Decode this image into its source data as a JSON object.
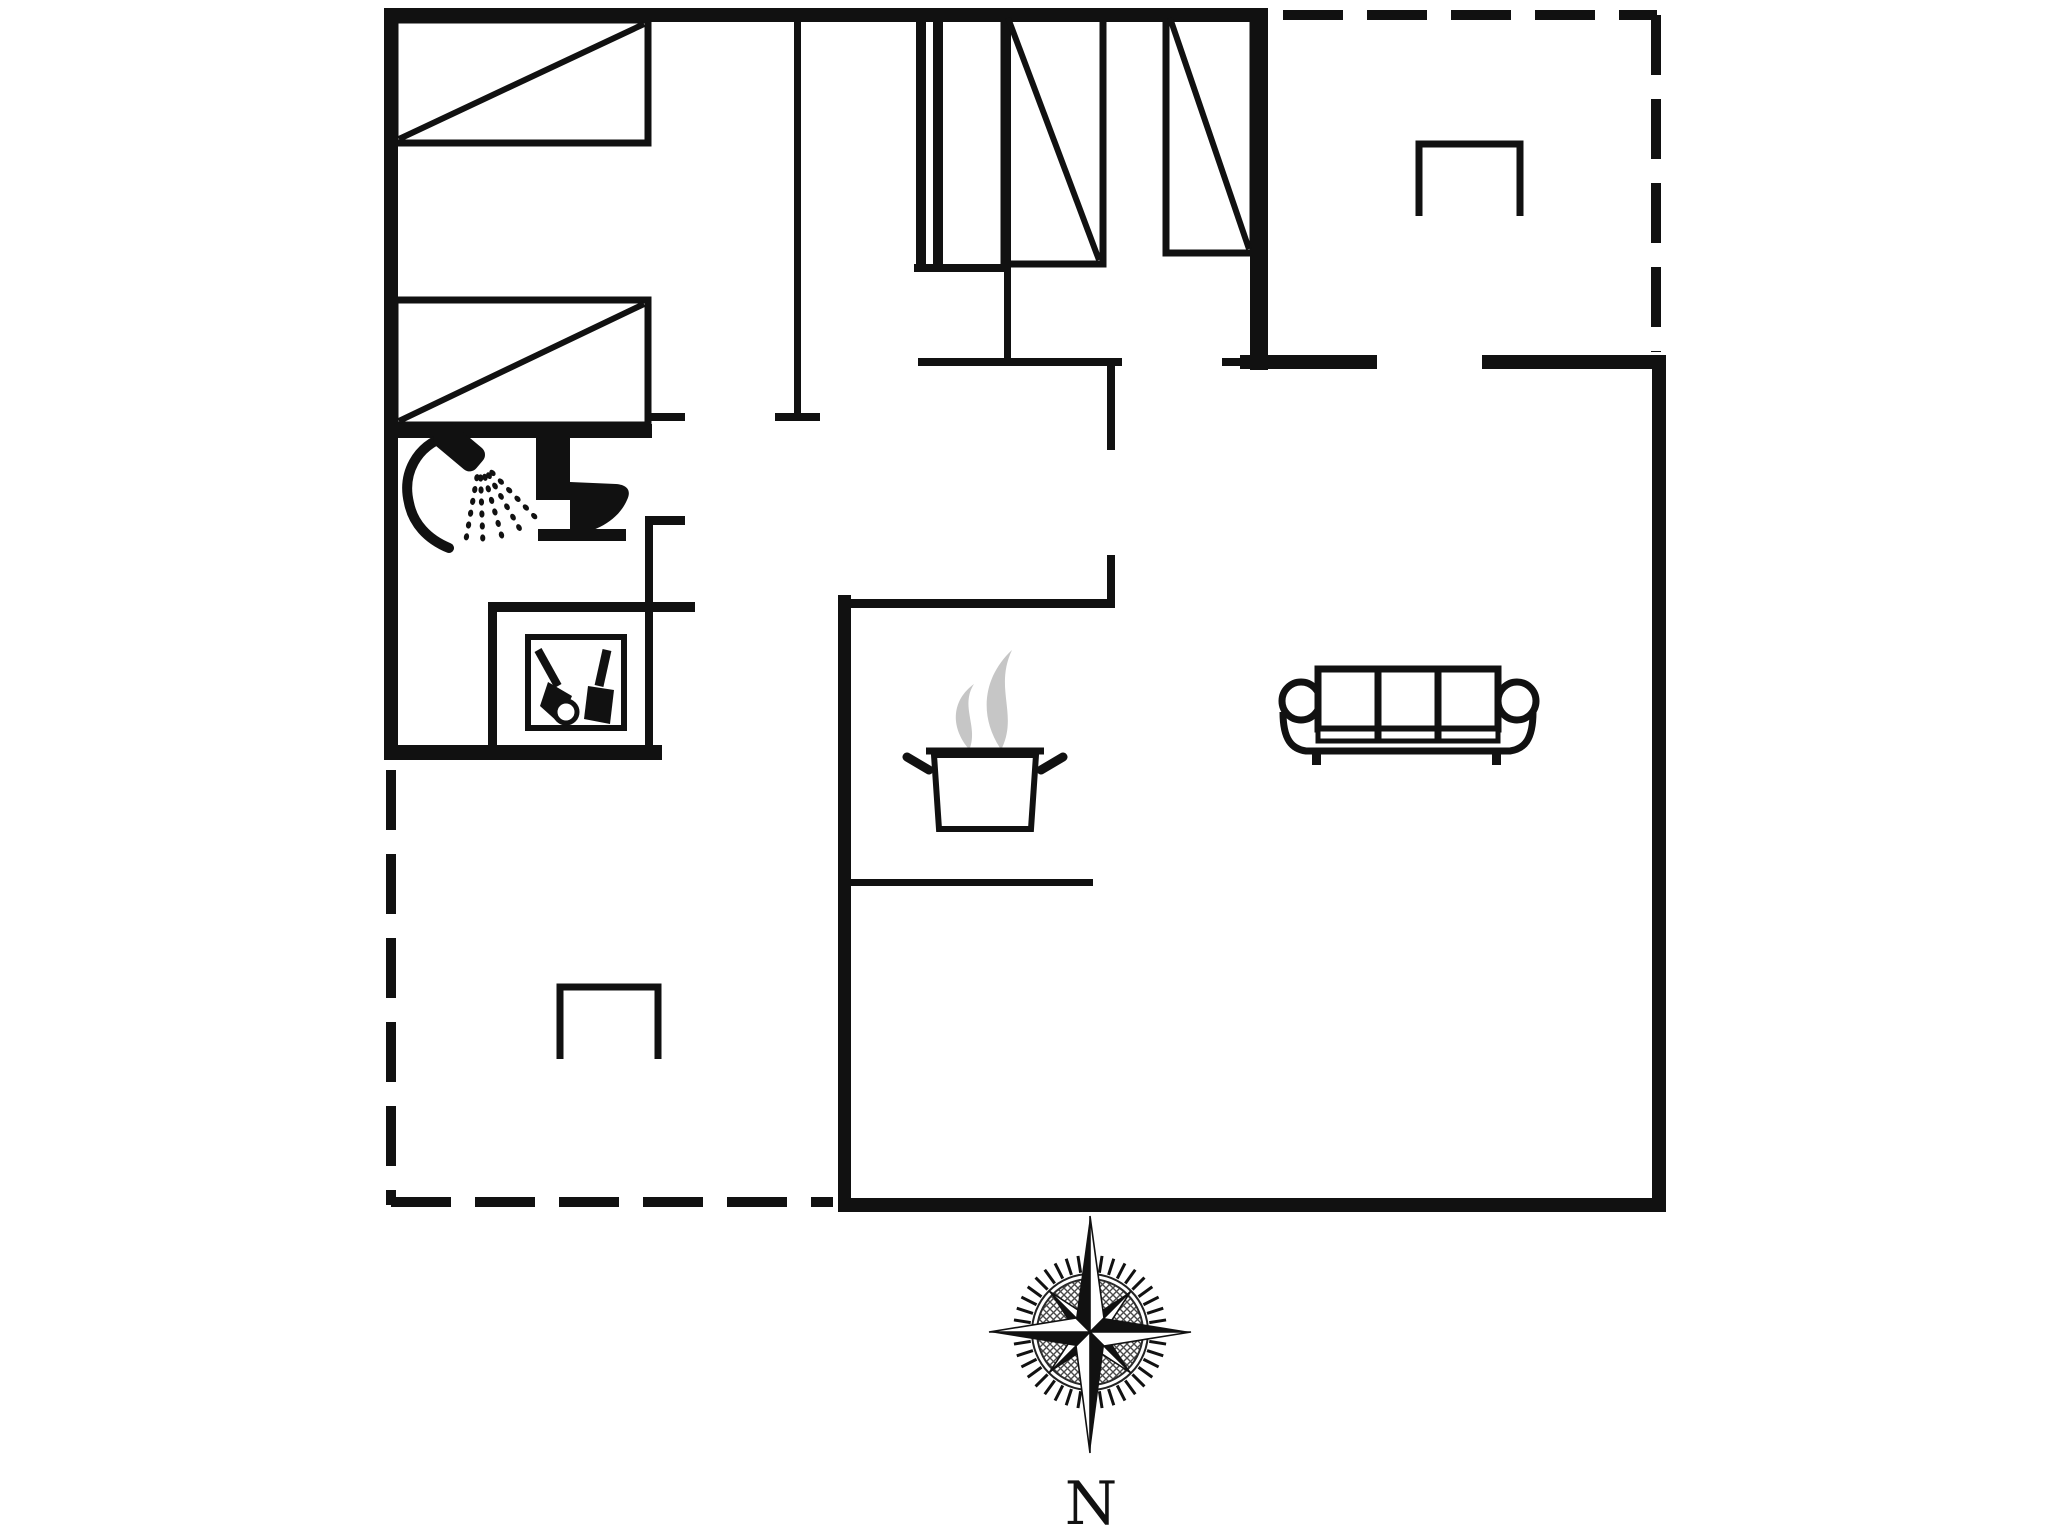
{
  "document": {
    "background": "#ffffff",
    "ink": "#111111",
    "steam_gray": "#c6c6c6"
  },
  "compass": {
    "north_label": "N",
    "cx": 1090,
    "cy": 1332,
    "tick_r1": 60,
    "tick_r2": 77,
    "tick_count": 40,
    "tick_sw": 3,
    "ring_r": 58,
    "disc_r": 53,
    "cardinal_len": [
      116,
      101,
      121,
      101
    ],
    "cardinal_hw": 14,
    "diag_len": 58,
    "diag_hw": 10,
    "outline_sw": 1.6
  },
  "plan": {
    "walls": [
      {
        "name": "outer-wall-top",
        "x": 384,
        "y": 8,
        "w": 884,
        "h": 14
      },
      {
        "name": "outer-wall-left",
        "x": 384,
        "y": 8,
        "w": 14,
        "h": 749
      },
      {
        "name": "bedroom1-south-wall",
        "x": 384,
        "y": 424,
        "w": 268,
        "h": 14
      },
      {
        "name": "bathroom-south-wall",
        "x": 384,
        "y": 745,
        "w": 278,
        "h": 15
      },
      {
        "name": "bedroom3-east-wall",
        "x": 1250,
        "y": 8,
        "w": 18,
        "h": 362
      },
      {
        "name": "living-north-wall-west",
        "x": 1240,
        "y": 355,
        "w": 137,
        "h": 14
      },
      {
        "name": "living-north-wall-east",
        "x": 1482,
        "y": 355,
        "w": 184,
        "h": 14
      },
      {
        "name": "living-east-wall",
        "x": 1652,
        "y": 355,
        "w": 14,
        "h": 857
      },
      {
        "name": "south-wall",
        "x": 838,
        "y": 1198,
        "w": 828,
        "h": 14
      },
      {
        "name": "kitchen-west-wall",
        "x": 838,
        "y": 595,
        "w": 13,
        "h": 615
      },
      {
        "name": "bedroom-partition-wall",
        "x": 794,
        "y": 14,
        "w": 7,
        "h": 402
      },
      {
        "name": "bedroom-partition-cap",
        "x": 775,
        "y": 413,
        "w": 45,
        "h": 8
      },
      {
        "name": "bedroom1-door-jamb",
        "x": 645,
        "y": 413,
        "w": 40,
        "h": 8
      },
      {
        "name": "bathroom-east-wall",
        "x": 645,
        "y": 518,
        "w": 8,
        "h": 232
      },
      {
        "name": "bathroom-door-jamb",
        "x": 645,
        "y": 516,
        "w": 40,
        "h": 9
      },
      {
        "name": "utility-niche-north-wall",
        "x": 488,
        "y": 602,
        "w": 207,
        "h": 10
      },
      {
        "name": "utility-niche-west-wall",
        "x": 488,
        "y": 602,
        "w": 9,
        "h": 150
      },
      {
        "name": "hall-north-wall",
        "x": 918,
        "y": 358,
        "w": 204,
        "h": 8
      },
      {
        "name": "hall-west-wall-upper",
        "x": 1107,
        "y": 358,
        "w": 8,
        "h": 92
      },
      {
        "name": "hall-door-jamb",
        "x": 1222,
        "y": 358,
        "w": 18,
        "h": 8
      },
      {
        "name": "hall-west-wall-lower",
        "x": 1107,
        "y": 555,
        "w": 8,
        "h": 51
      },
      {
        "name": "kitchen-north-wall",
        "x": 845,
        "y": 599,
        "w": 270,
        "h": 9
      },
      {
        "name": "kitchen-counter-edge",
        "x": 845,
        "y": 879,
        "w": 248,
        "h": 7
      },
      {
        "name": "bedroom2-east-wall",
        "x": 1004,
        "y": 12,
        "w": 7,
        "h": 350
      },
      {
        "name": "closet-line-a",
        "x": 916,
        "y": 12,
        "w": 10,
        "h": 260
      },
      {
        "name": "closet-line-b",
        "x": 933,
        "y": 12,
        "w": 10,
        "h": 260
      },
      {
        "name": "closet-bottom",
        "x": 914,
        "y": 264,
        "w": 94,
        "h": 8
      }
    ],
    "outlines": [
      {
        "name": "bed-1",
        "x": 395,
        "y": 20,
        "w": 253,
        "h": 123,
        "sw": 7
      },
      {
        "name": "bed-2",
        "x": 395,
        "y": 300,
        "w": 253,
        "h": 125,
        "sw": 7
      },
      {
        "name": "wardrobe-1",
        "x": 1004,
        "y": 14,
        "w": 99,
        "h": 250,
        "sw": 7
      },
      {
        "name": "wardrobe-2",
        "x": 1166,
        "y": 14,
        "w": 87,
        "h": 239,
        "sw": 7
      },
      {
        "name": "utility-appliance",
        "x": 528,
        "y": 637,
        "w": 96,
        "h": 91,
        "sw": 6
      }
    ],
    "diagonals": [
      {
        "name": "bed-1-diagonal",
        "x1": 399,
        "y1": 139,
        "x2": 644,
        "y2": 24,
        "sw": 6
      },
      {
        "name": "bed-2-diagonal",
        "x1": 399,
        "y1": 421,
        "x2": 644,
        "y2": 304,
        "sw": 6
      },
      {
        "name": "wardrobe-1-diagonal",
        "x1": 1008,
        "y1": 18,
        "x2": 1099,
        "y2": 260,
        "sw": 6
      },
      {
        "name": "wardrobe-2-diagonal",
        "x1": 1170,
        "y1": 18,
        "x2": 1249,
        "y2": 249,
        "sw": 6
      }
    ],
    "dashed_edges": [
      {
        "name": "terrace-top-boundary-h",
        "x1": 1283,
        "y1": 15,
        "x2": 1657,
        "y2": 15,
        "sw": 10,
        "dash": "60 24"
      },
      {
        "name": "terrace-top-boundary-v",
        "x1": 1656,
        "y1": 15,
        "x2": 1656,
        "y2": 352,
        "sw": 10,
        "dash": "60 24"
      },
      {
        "name": "terrace-left-boundary-v",
        "x1": 391,
        "y1": 770,
        "x2": 391,
        "y2": 1205,
        "sw": 10,
        "dash": "60 24"
      },
      {
        "name": "terrace-left-boundary-h",
        "x1": 391,
        "y1": 1202,
        "x2": 833,
        "y2": 1202,
        "sw": 10,
        "dash": "60 24"
      }
    ],
    "polylines": [
      {
        "name": "terrace-furniture-top",
        "points": "1419,216 1419,144 1520,144 1520,216",
        "sw": 7
      },
      {
        "name": "terrace-furniture-bottom",
        "points": "560,1059 560,987 658,987 658,1059",
        "sw": 7
      }
    ],
    "shower": {
      "head": [
        459,
        447
      ],
      "head_rot": 40,
      "head_w": 54,
      "head_h": 28,
      "hose": "M 447,436 C 416,446 402,474 409,503 C 413,523 427,539 449,548",
      "hose_sw": 10,
      "spray_origin": [
        480,
        460
      ],
      "spray_angles": [
        46,
        60,
        74,
        88,
        100
      ],
      "spray_dists": [
        18,
        30,
        42,
        54,
        66,
        78
      ]
    },
    "toilet": {
      "tank": [
        536,
        434,
        34,
        66
      ],
      "button": [
        545,
        426,
        11,
        8
      ],
      "bowl": "M 570,482 L 616,484 C 629,485 631,492 627,500 C 618,521 594,533 571,535 L 570,535 Z",
      "base": [
        538,
        529,
        88,
        12
      ]
    },
    "utility_items": {
      "handle": [
        538,
        650,
        558,
        686
      ],
      "handle_sw": 8,
      "head": "548,682 572,696 560,724 540,706",
      "neck": [
        607,
        650,
        599,
        686
      ],
      "neck_sw": 9,
      "bottle": "588,686 614,690 610,724 584,719",
      "ring": [
        566,
        712,
        11
      ],
      "ring_sw": 5
    },
    "stove": {
      "rim": [
        926,
        751,
        1044,
        751
      ],
      "rim_sw": 7,
      "body": "934,755 1036,755 1031,829 939,829",
      "body_sw": 6,
      "handles": [
        [
          929,
          770,
          907,
          757
        ],
        [
          1041,
          770,
          1063,
          757
        ]
      ],
      "handle_sw": 9,
      "steam": [
        "M 968,748 C 950,726 952,700 974,684 C 960,706 978,726 970,748 Z",
        "M 1000,748 C 978,714 984,676 1012,650 C 994,688 1018,714 1002,748 Z"
      ]
    },
    "sofa": {
      "body": [
        1318,
        669,
        180,
        60
      ],
      "dividers": [
        1378,
        1438
      ],
      "band": [
        1318,
        729,
        180,
        12
      ],
      "arms": [
        [
          1301,
          701
        ],
        [
          1517,
          701
        ]
      ],
      "arm_r": 19,
      "base": "M 1283,712 C 1283,740 1292,749 1306,751 L 1510,751 C 1524,749 1533,740 1533,712",
      "legs": [
        [
          1312,
          751
        ],
        [
          1492,
          751
        ]
      ],
      "leg_w": 9,
      "leg_h": 14,
      "sw": 7
    }
  }
}
